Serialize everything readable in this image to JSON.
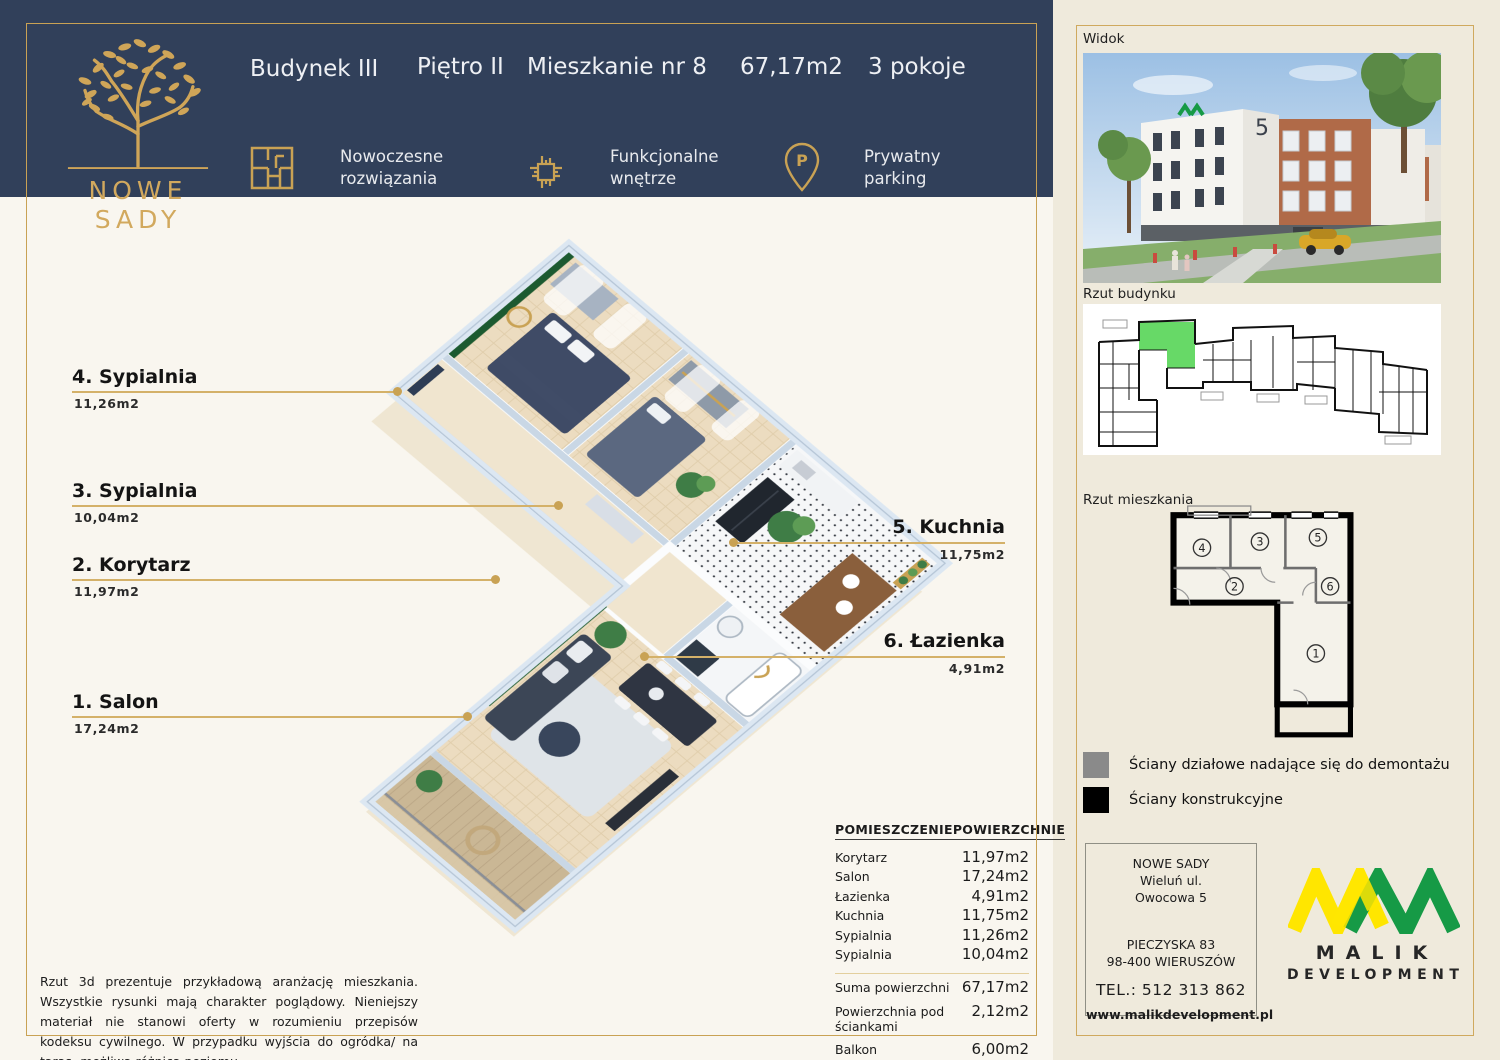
{
  "header": {
    "brand": "NOWE SADY",
    "title": {
      "building": "Budynek III",
      "floor": "Piętro II",
      "unit": "Mieszkanie nr 8",
      "area": "67,17m2",
      "rooms": "3 pokoje"
    },
    "features": [
      {
        "icon": "floorplan-icon",
        "label": "Nowoczesne rozwiązania"
      },
      {
        "icon": "chip-icon",
        "label": "Funkcjonalne wnętrze"
      },
      {
        "icon": "parking-pin-icon",
        "label": "Prywatny parking"
      }
    ]
  },
  "plan_labels": {
    "left": [
      {
        "name": "4. Sypialnia",
        "area": "11,26m2"
      },
      {
        "name": "3. Sypialnia",
        "area": "10,04m2"
      },
      {
        "name": "2. Korytarz",
        "area": "11,97m2"
      },
      {
        "name": "1. Salon",
        "area": "17,24m2"
      }
    ],
    "right": [
      {
        "name": "5. Kuchnia",
        "area": "11,75m2"
      },
      {
        "name": "6. Łazienka",
        "area": "4,91m2"
      }
    ]
  },
  "disclaimer": "Rzut 3d prezentuje przykładową aranżację mieszkania. Wszystkie rysunki mają charakter poglądowy. Nieniejszy materiał nie stanowi oferty w rozumieniu przepisów kodeksu cywilnego. W przypadku wyjścia do ogródka/ na taras- możliwa różnica poziomu.",
  "table": {
    "col1": "POMIESZCZENIE",
    "col2": "POWIERZCHNIE",
    "rows": [
      [
        "Korytarz",
        "11,97m2"
      ],
      [
        "Salon",
        "17,24m2"
      ],
      [
        "Łazienka",
        "4,91m2"
      ],
      [
        "Kuchnia",
        "11,75m2"
      ],
      [
        "Sypialnia",
        "11,26m2"
      ],
      [
        "Sypialnia",
        "10,04m2"
      ]
    ],
    "summary": [
      [
        "Suma powierzchni",
        "67,17m2"
      ],
      [
        "Powierzchnia pod ściankami",
        "2,12m2"
      ],
      [
        "Balkon",
        "6,00m2"
      ],
      [
        "Balkon",
        "3,80m2"
      ]
    ]
  },
  "sidebar": {
    "widok_label": "Widok",
    "rzut_budynku_label": "Rzut budynku",
    "rzut_mieszkania_label": "Rzut mieszkania",
    "building_number": "5",
    "unit_rooms": [
      "4",
      "3",
      "5",
      "2",
      "6",
      "1"
    ],
    "legend": [
      {
        "color": "#8a8a8a",
        "label": "Ściany działowe nadające się do demontażu"
      },
      {
        "color": "#000000",
        "label": "Ściany konstrukcyjne"
      }
    ],
    "contact": {
      "name": "NOWE SADY",
      "address": "Wieluń ul. Owocowa 5",
      "line3": "PIECZYSKA 83",
      "line4": "98-400 WIERUSZÓW",
      "phone": "TEL.: 512 313 862",
      "web": "www.malikdevelopment.pl"
    },
    "brand": {
      "name": "MALIK",
      "sub": "DEVELOPMENT"
    }
  },
  "colors": {
    "navy": "#31405a",
    "gold": "#c9a254",
    "cream_main": "#f9f6ef",
    "beige_sidebar": "#efeadc",
    "unit_highlight_green": "#67d967",
    "accent_wall_green": "#1c5a30",
    "brand_yellow": "#ffe600",
    "brand_green": "#169a46"
  }
}
